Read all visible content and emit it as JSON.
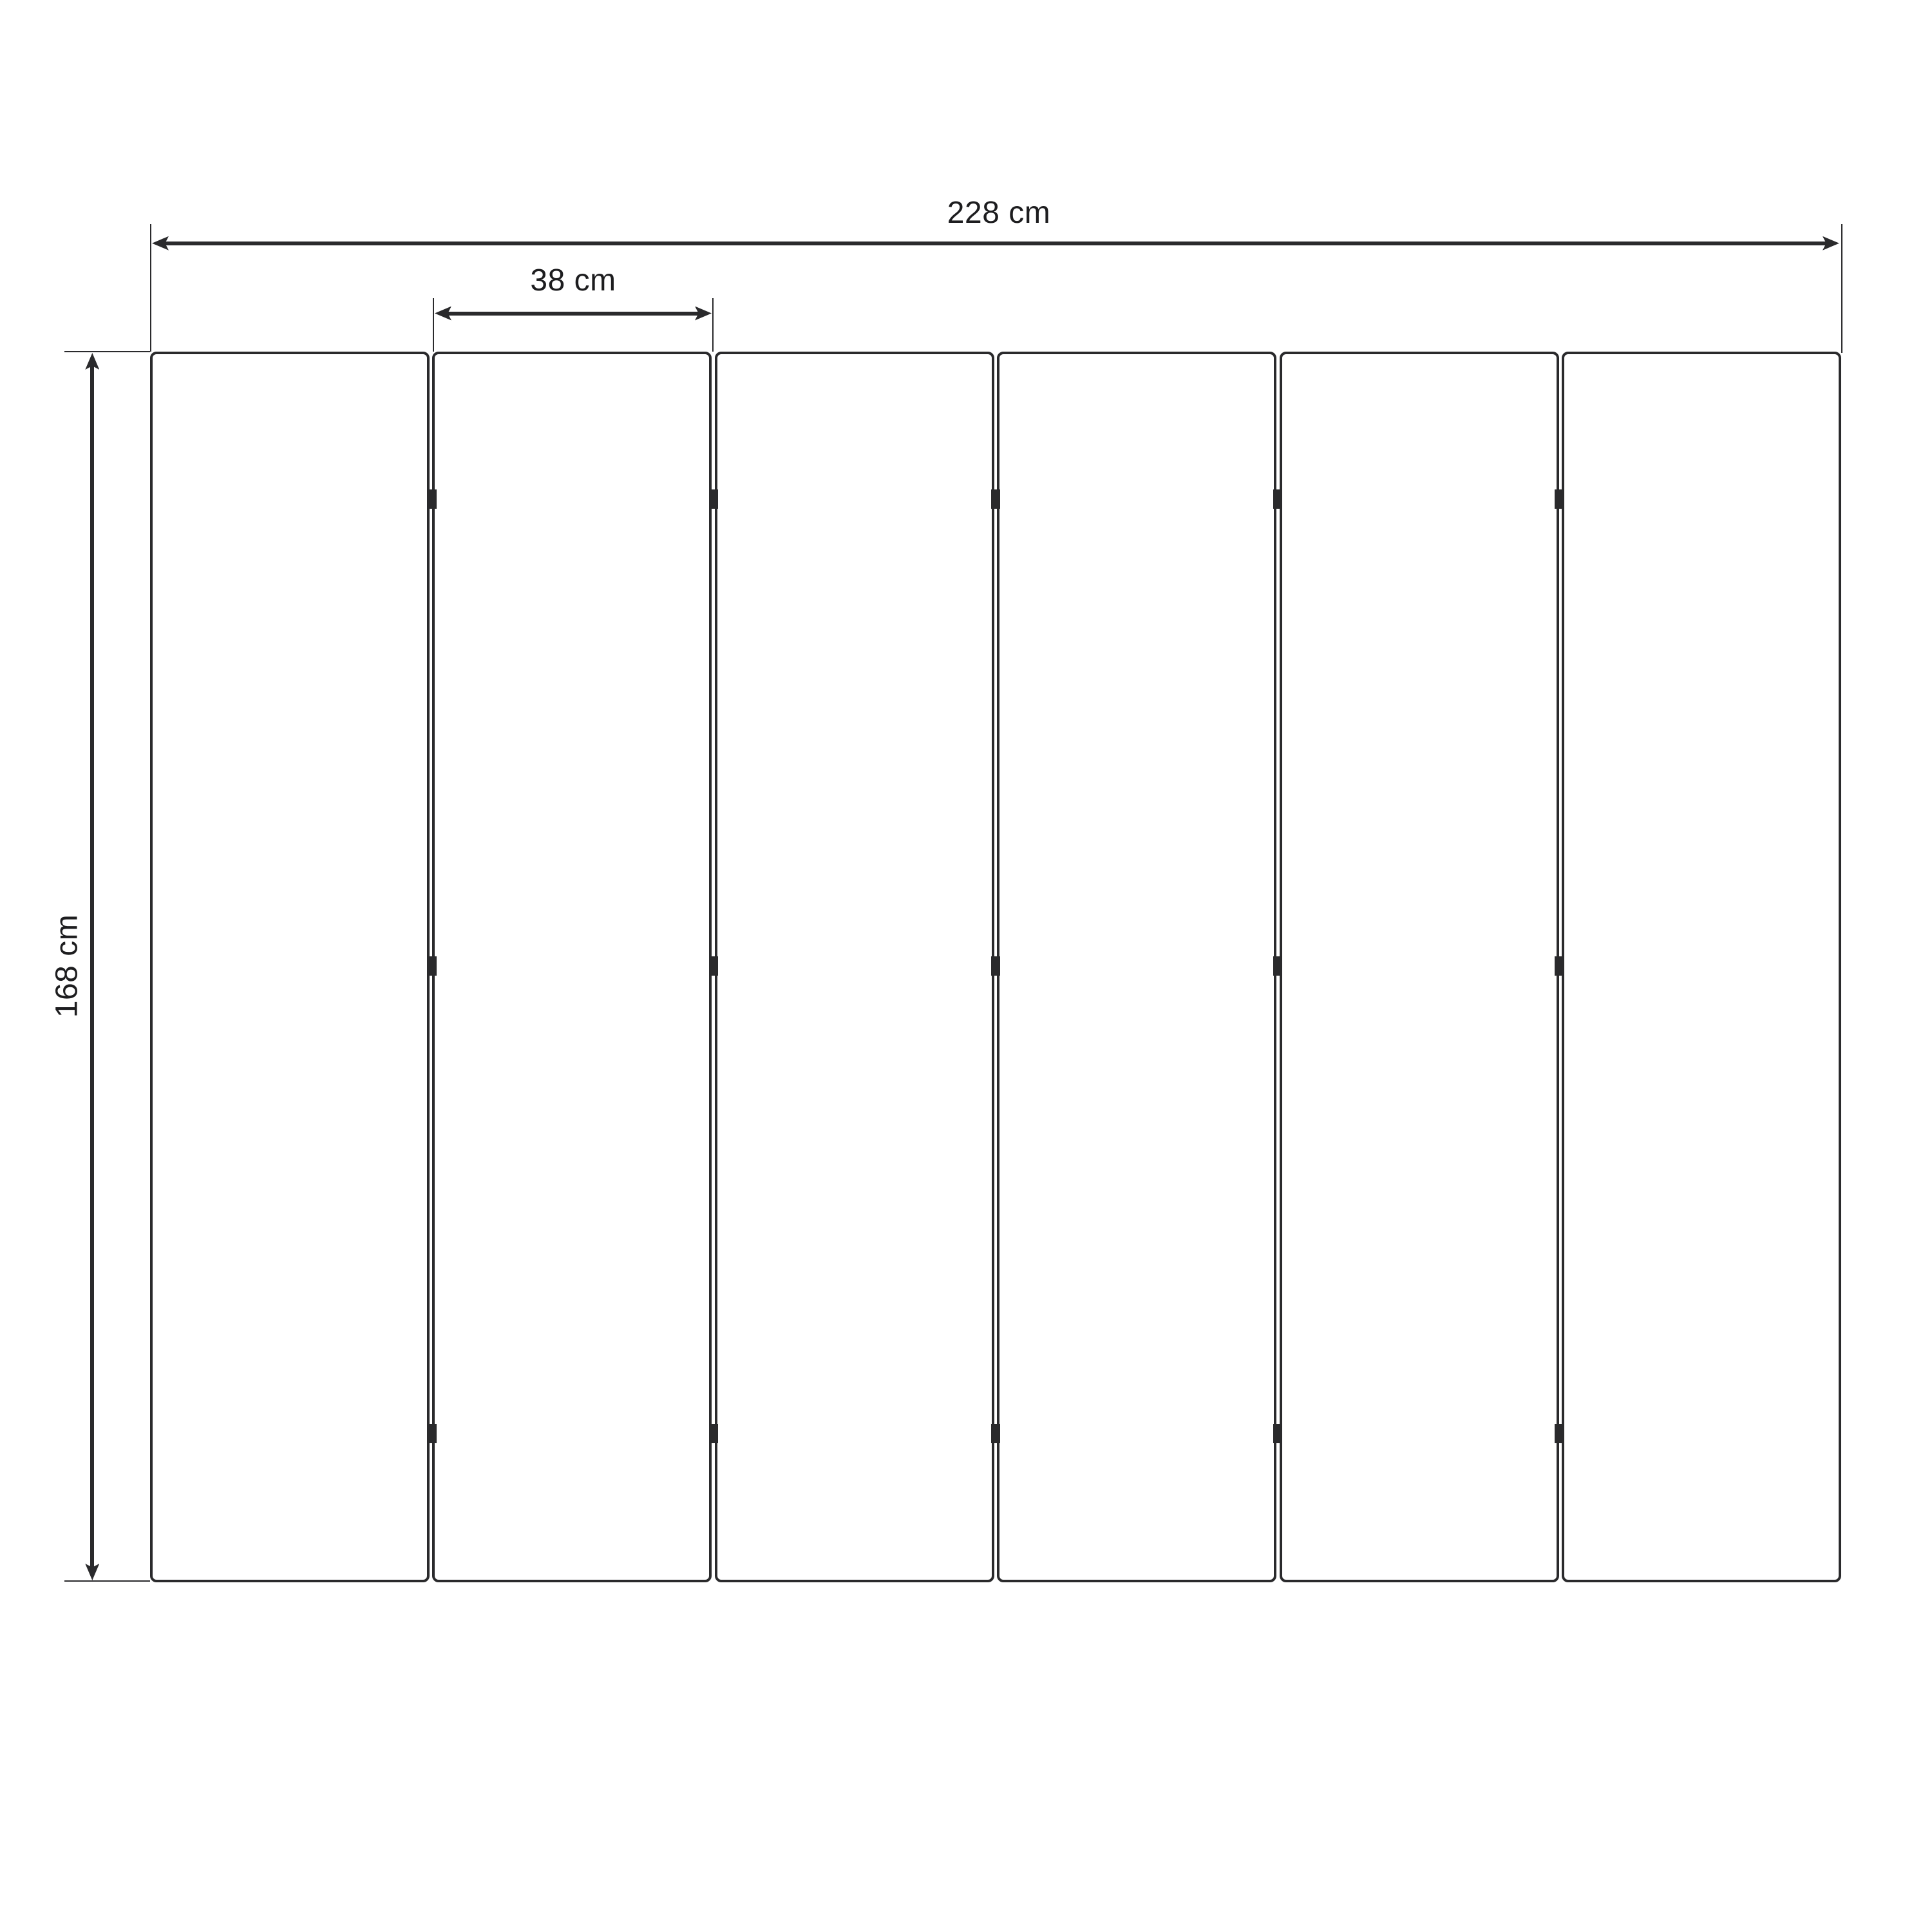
{
  "diagram": {
    "type": "technical-drawing",
    "subject": "six-panel folding screen, front elevation with dimensions",
    "panel_count": 6,
    "junction_count": 5,
    "hinges_per_junction": 3,
    "hinge_row_fractions": [
      0.12,
      0.499,
      0.879
    ],
    "dimensions": {
      "total_width": {
        "value": 228,
        "unit": "cm",
        "label": "228 cm"
      },
      "panel_width": {
        "value": 38,
        "unit": "cm",
        "label": "38 cm"
      },
      "height": {
        "value": 168,
        "unit": "cm",
        "label": "168 cm"
      }
    },
    "colors": {
      "line": "#2a2a2c",
      "text": "#1d1d1f",
      "background": "#ffffff"
    }
  }
}
